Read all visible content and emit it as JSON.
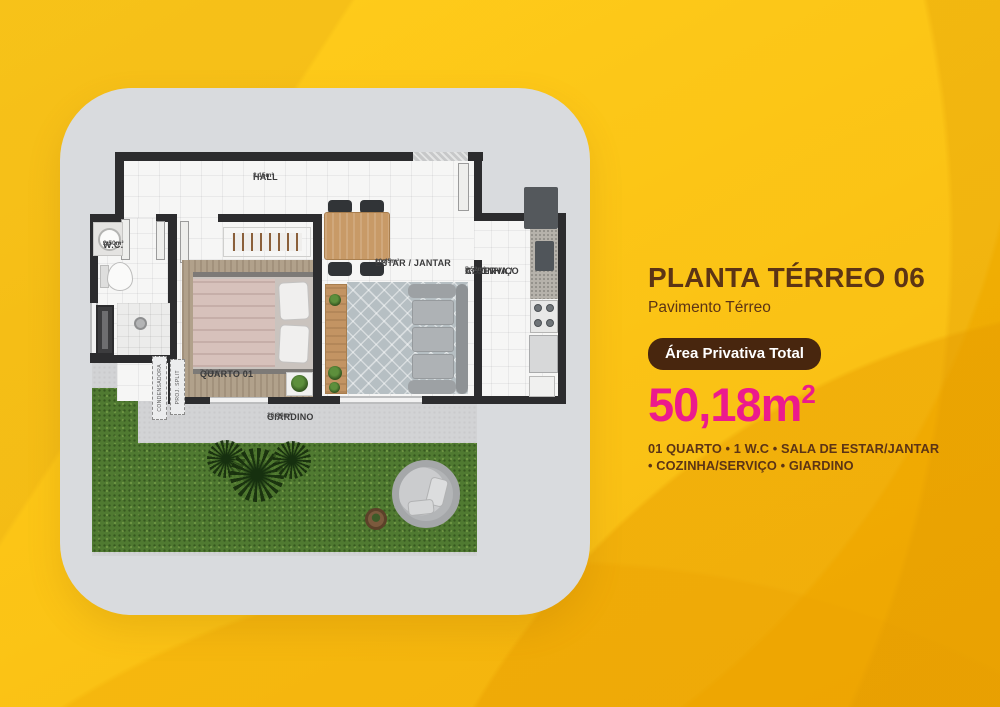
{
  "panel": {
    "title": "PLANTA TÉRREO 06",
    "subtitle": "Pavimento Térreo",
    "badge_label": "Área Privativa Total",
    "area_value": "50,18m",
    "area_exponent": "2",
    "features_line1": "01 QUARTO • 1 W.C • SALA DE ESTAR/JANTAR",
    "features_line2": "• COZINHA/SERVIÇO • GIARDINO"
  },
  "floorplan": {
    "hall": {
      "name": "HALL",
      "area": "3,15m²"
    },
    "wc": {
      "name": "W.C.",
      "area": "2,50m²"
    },
    "quarto": {
      "name": "QUARTO 01",
      "area": "7,06m²"
    },
    "estar": {
      "name": "ESTAR / JANTAR",
      "area": "10,45m²"
    },
    "cozinha": {
      "name_line1": "COZINHA /",
      "name_line2": "A. SERVIÇO",
      "area": "5,52m²"
    },
    "giardino": {
      "name": "GIARDINO",
      "area": "16,84m²"
    },
    "condensadora": "CONDENSADORA",
    "proj_split": "PROJ. SPLIT"
  },
  "colors": {
    "background_yellow": "#f9ba04",
    "accent_pink": "#ec1a8d",
    "text_brown": "#5c3415",
    "badge_brown": "#48260e",
    "grass_green": "#507a31",
    "wall_dark": "#2c2c2e",
    "card_gray": "#d9dbde"
  }
}
